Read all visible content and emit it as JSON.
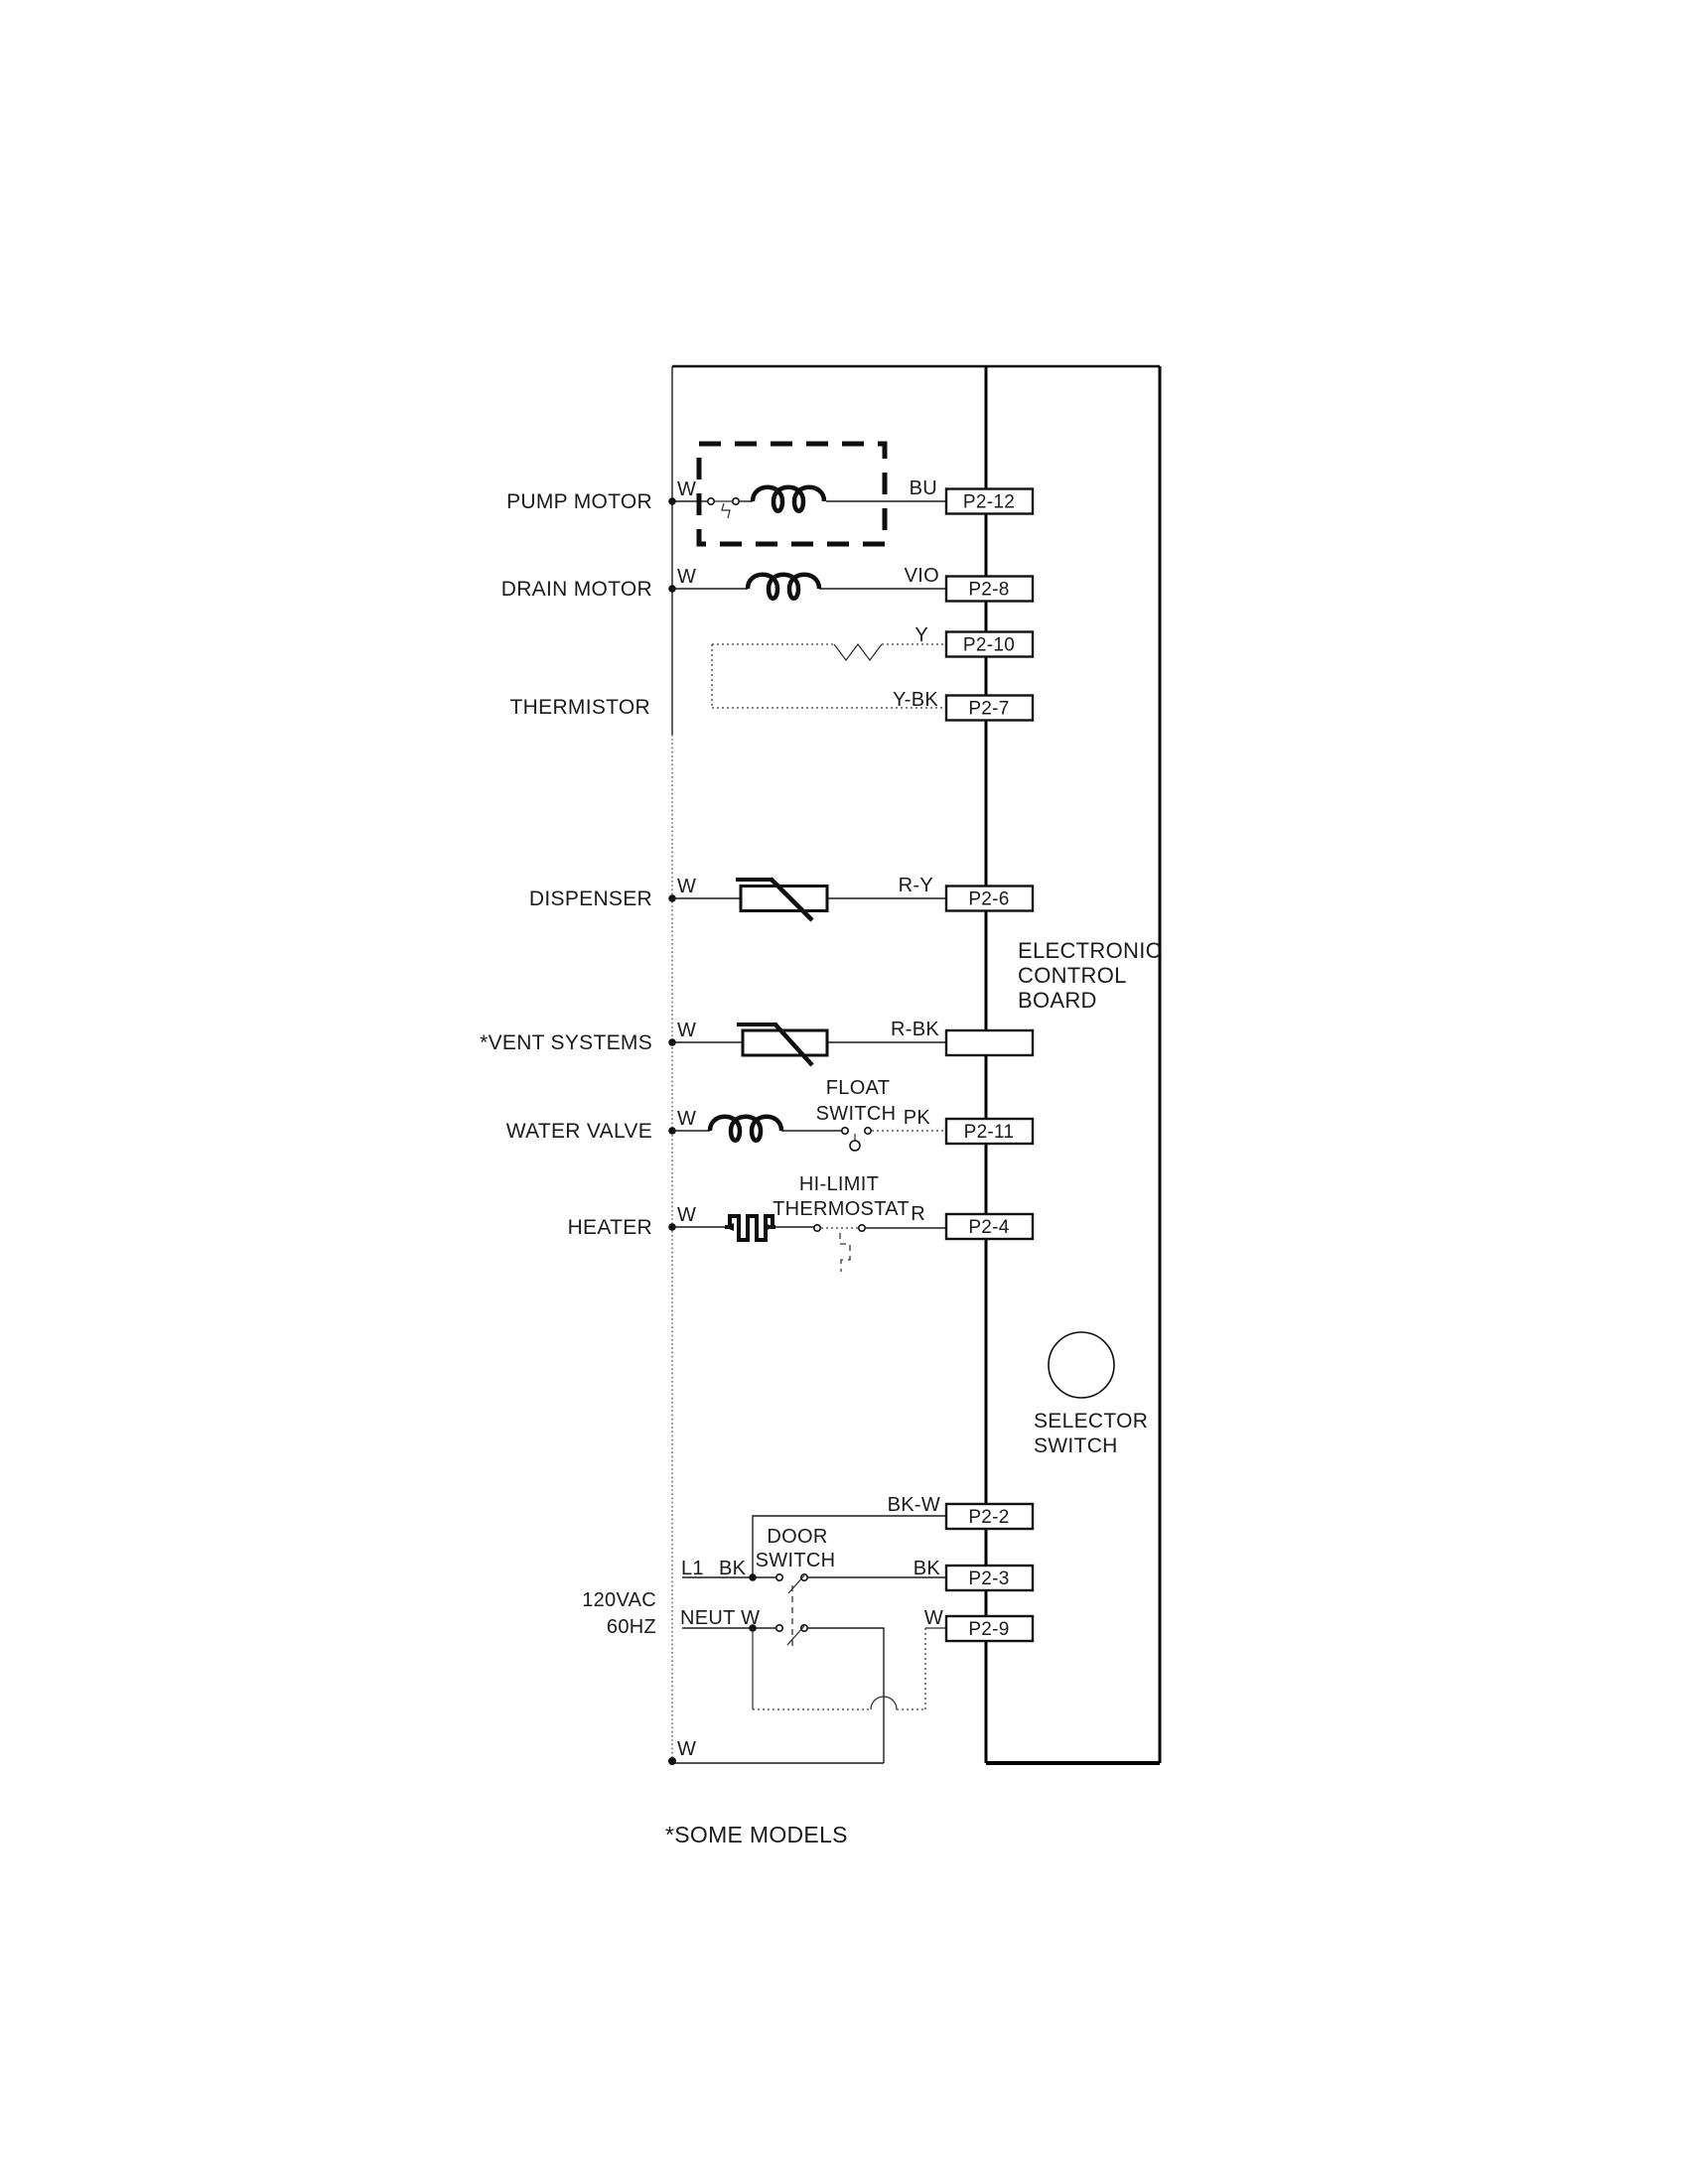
{
  "labels": {
    "pump": "PUMP MOTOR",
    "drain": "DRAIN MOTOR",
    "thermistor": "THERMISTOR",
    "dispenser": "DISPENSER",
    "vent": "*VENT SYSTEMS",
    "water": "WATER VALVE",
    "heater": "HEATER"
  },
  "wires": {
    "pump_w": "W",
    "pump_bu": "BU",
    "drain_w": "W",
    "drain_vio": "VIO",
    "therm_y": "Y",
    "therm_ybk": "Y-BK",
    "disp_w": "W",
    "disp_ry": "R-Y",
    "vent_w": "W",
    "vent_rbk": "R-BK",
    "water_w": "W",
    "water_pk": "PK",
    "heater_w": "W",
    "heater_r": "R",
    "bkw": "BK-W",
    "l1": "L1",
    "l1_bk": "BK",
    "bk_right": "BK",
    "neut": "NEUT W",
    "w_right": "W",
    "bus_w": "W"
  },
  "connectors": {
    "pump": "P2-12",
    "drain": "P2-8",
    "therm_y": "P2-10",
    "therm_ybk": "P2-7",
    "disp": "P2-6",
    "vent": "",
    "water": "P2-11",
    "heater": "P2-4",
    "bkw": "P2-2",
    "bk": "P2-3",
    "neut": "P2-9"
  },
  "board": {
    "line1": "ELECTRONIC",
    "line2": "CONTROL",
    "line3": "BOARD"
  },
  "selector": {
    "line1": "SELECTOR",
    "line2": "SWITCH"
  },
  "float_switch": {
    "line1": "FLOAT",
    "line2": "SWITCH"
  },
  "hi_limit": {
    "line1": "HI-LIMIT",
    "line2": "THERMOSTAT"
  },
  "door": {
    "line1": "DOOR",
    "line2": "SWITCH"
  },
  "power": {
    "vac": "120VAC",
    "hz": "60HZ"
  },
  "footnote": "*SOME MODELS"
}
